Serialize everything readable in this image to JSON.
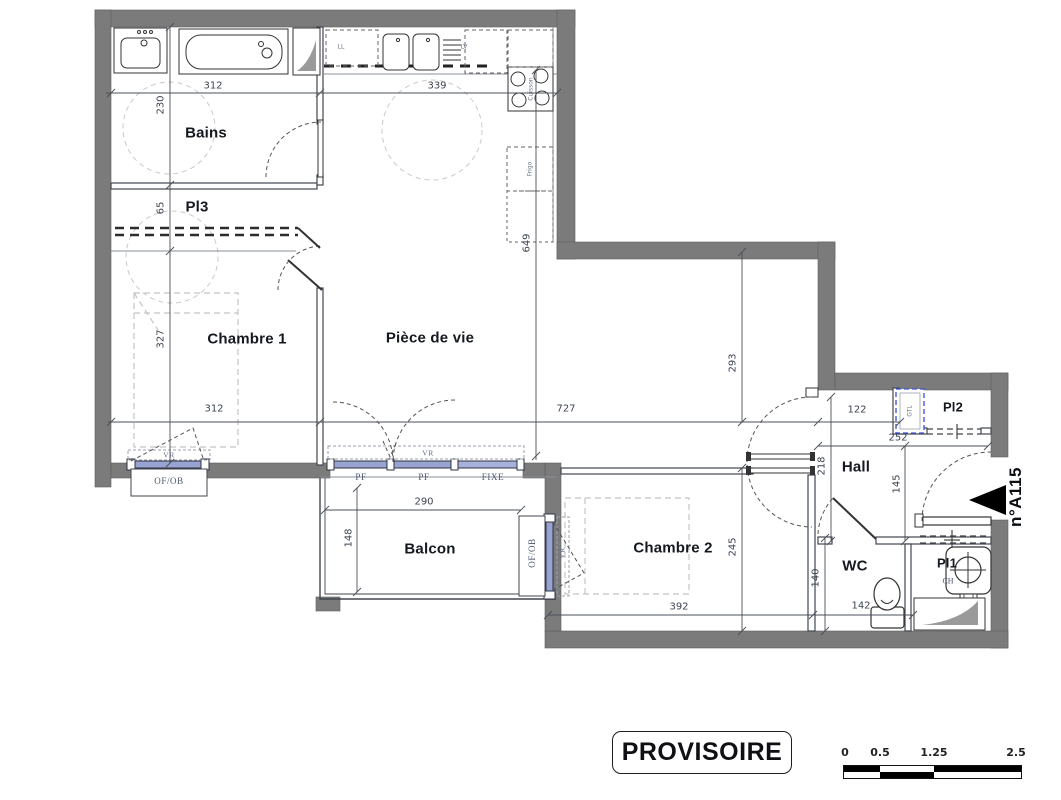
{
  "plan": {
    "unit_label": "n°A115",
    "stamp": "PROVISOIRE",
    "rooms": {
      "bains": "Bains",
      "pl3": "Pl3",
      "chambre1": "Chambre 1",
      "piece_de_vie": "Pièce de vie",
      "balcon": "Balcon",
      "chambre2": "Chambre 2",
      "hall": "Hall",
      "wc": "WC",
      "pl1": "Pl1",
      "pl2": "Pl2"
    },
    "equipment": {
      "ll": "LL",
      "lv": "LV",
      "cuisson": "Cuisson",
      "frigo": "Frigo",
      "ch": "CH",
      "gtl": "GTL"
    },
    "windows": {
      "vr": "VR",
      "of_ob": "OF/OB",
      "pf": "PF",
      "fixe": "FIXE"
    },
    "dims": {
      "bains_width": "312",
      "kitchen_width": "339",
      "bains_depth": "230",
      "pl3_depth": "65",
      "chambre1_depth": "327",
      "chambre1_width": "312",
      "living_width": "727",
      "living_depth": "649",
      "living_east_depth": "293",
      "hall_niche_width": "122",
      "hall_width": "252",
      "hall_opening_depth": "218",
      "hall_depth": "145",
      "balcon_width": "290",
      "balcon_depth": "148",
      "chambre2_width": "392",
      "chambre2_depth": "245",
      "wc_depth": "140",
      "wc_width": "142"
    },
    "scale_bar": {
      "t0": "0",
      "t1": "0.5",
      "t2": "1.25",
      "t3": "2.5"
    },
    "colors": {
      "wall": "#7b7b7b",
      "window_glass": "#99a3d1",
      "dimension_text": "#3c4350",
      "room_text": "#14181f"
    }
  }
}
